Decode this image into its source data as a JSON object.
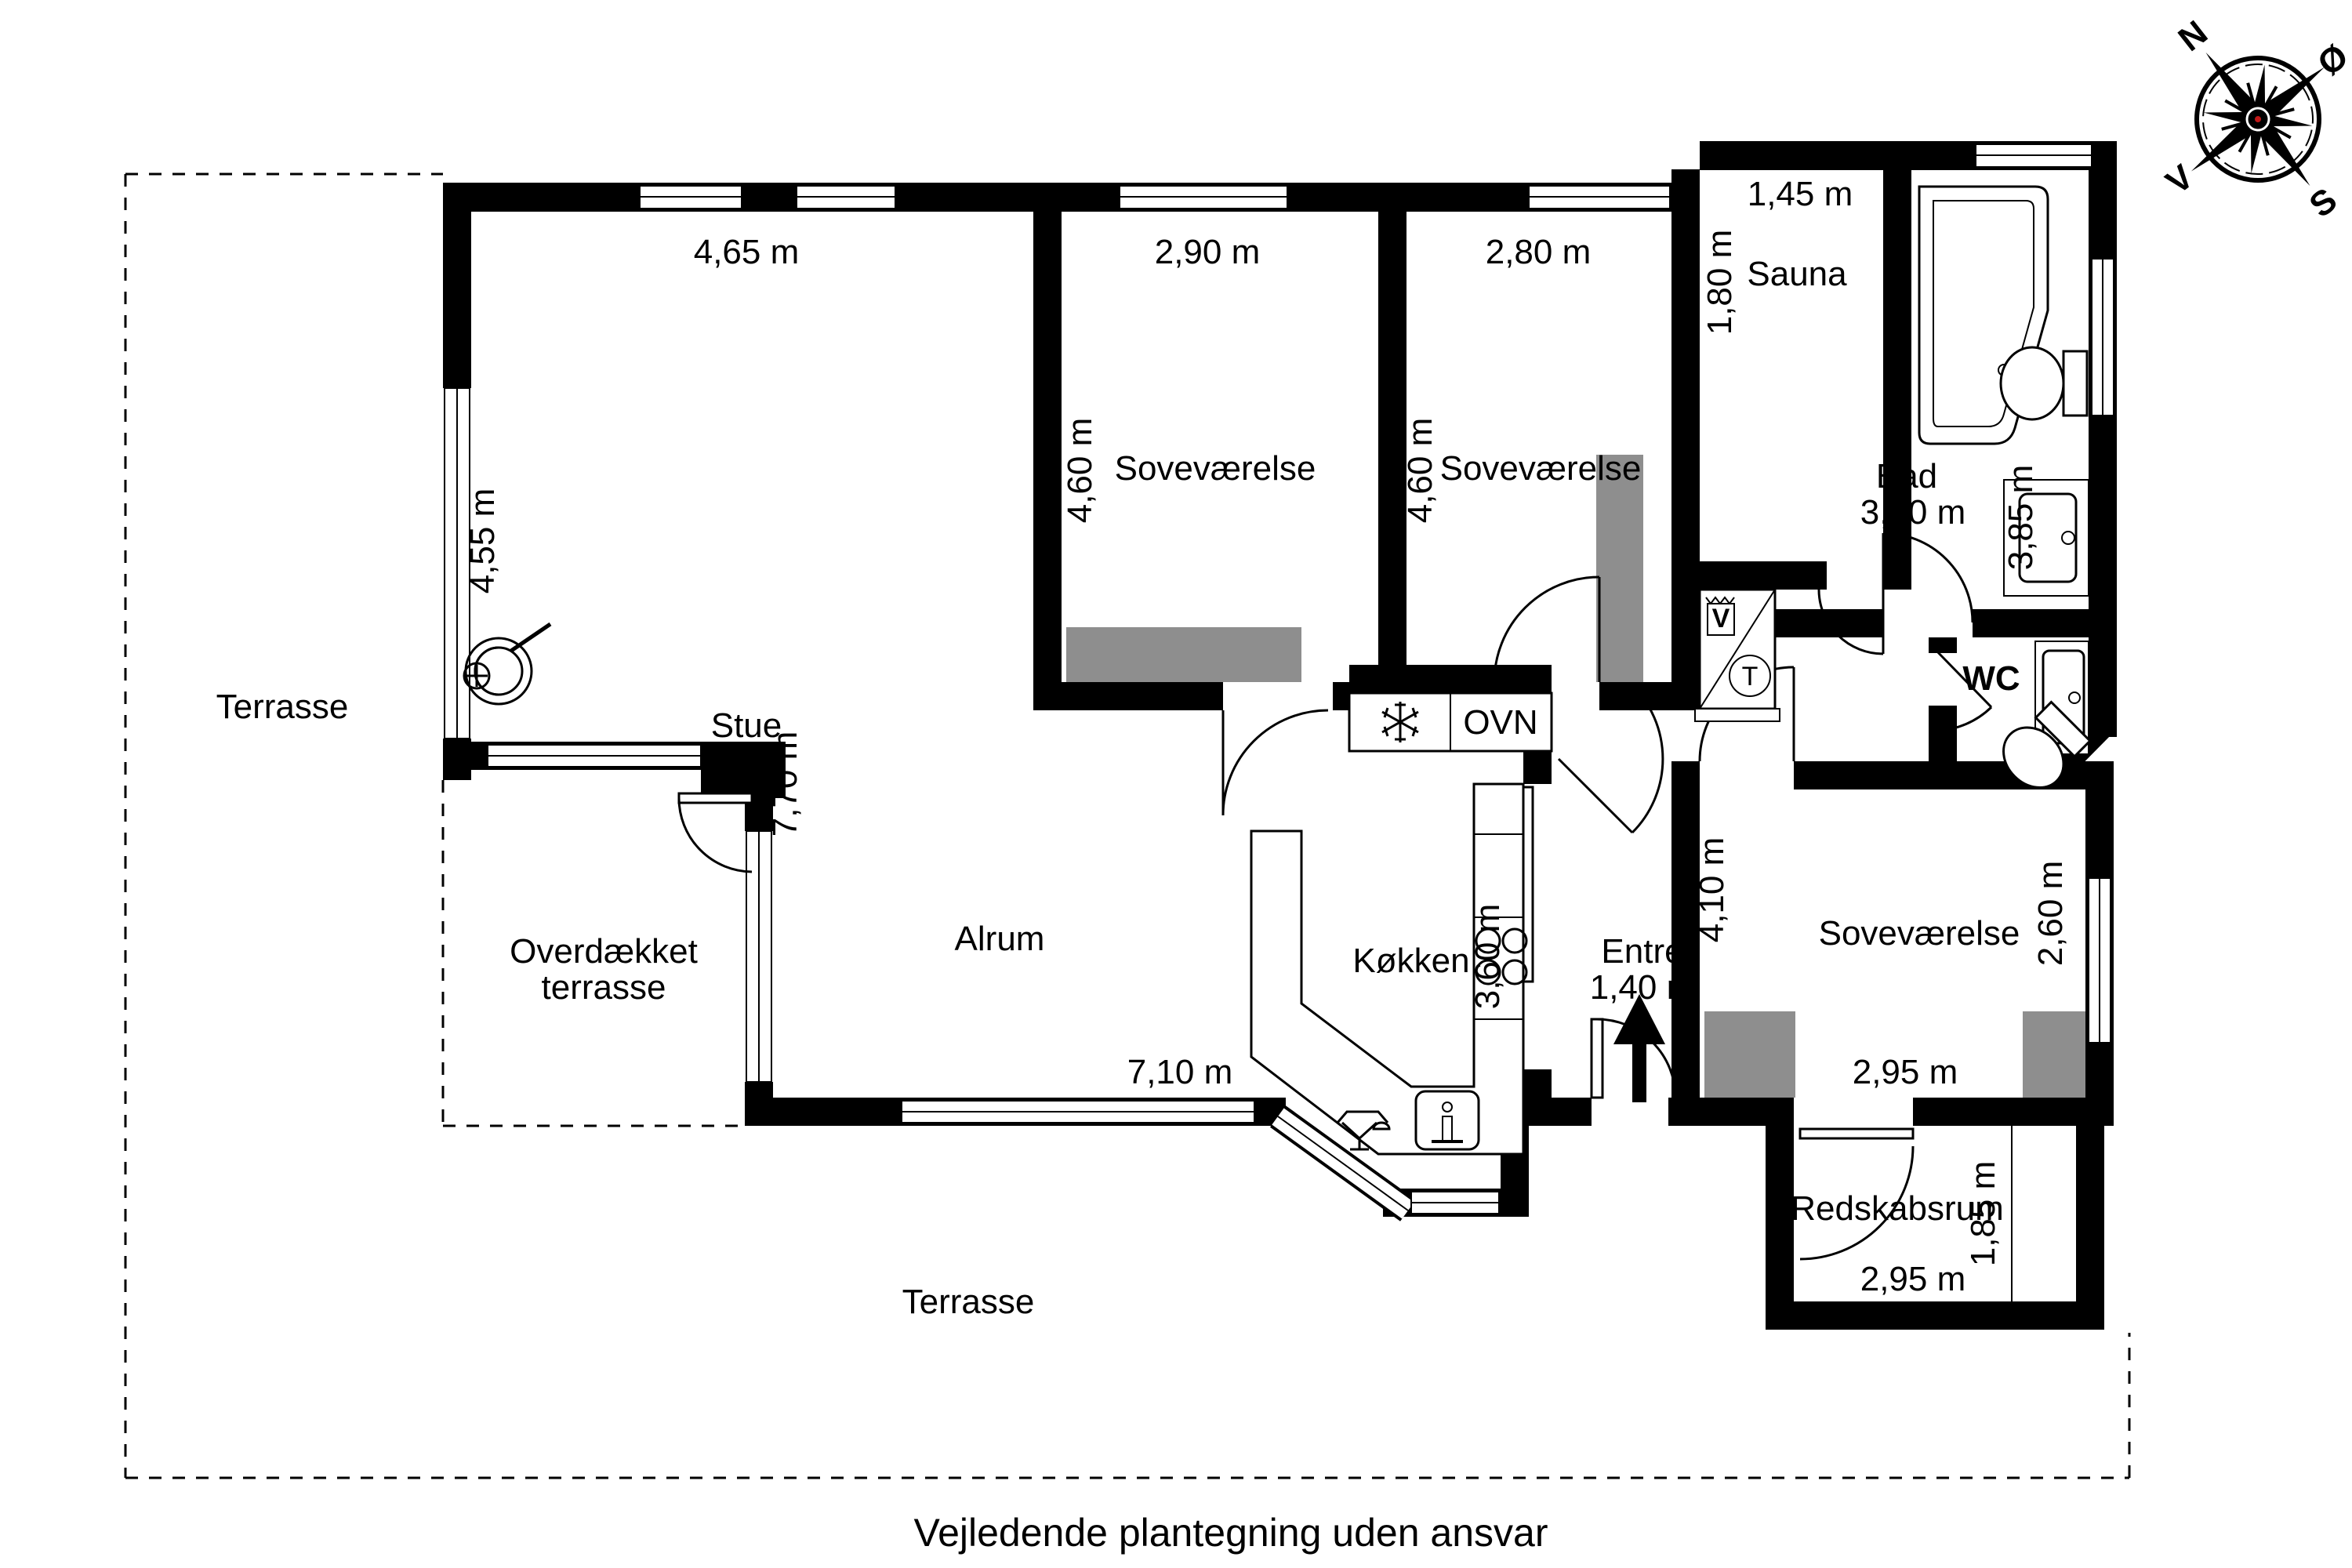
{
  "page": {
    "caption": "Vejledende plantegning uden ansvar"
  },
  "colors": {
    "wall": "#000000",
    "background": "#ffffff",
    "wardrobe": "#8e8e8e",
    "line": "#000000"
  },
  "compass": {
    "north": "N",
    "east": "Ø",
    "south": "S",
    "west": "V"
  },
  "rooms": {
    "stue": {
      "label": "Stue",
      "width": "4,65 m",
      "side": "4,55 m"
    },
    "sovevaerelse1": {
      "label": "Soveværelse",
      "width": "2,90 m",
      "depth": "4,60 m"
    },
    "sovevaerelse2": {
      "label": "Soveværelse",
      "width": "2,80 m",
      "depth": "4,60 m"
    },
    "sauna": {
      "label": "Sauna",
      "width": "1,45 m",
      "depth": "1,80 m"
    },
    "bad": {
      "label": "Bad",
      "width": "3,20 m",
      "depth": "3,85 m"
    },
    "wc": {
      "label": "WC"
    },
    "sovevaerelse3": {
      "label": "Soveværelse",
      "width": "2,95 m",
      "window_side": "2,60 m"
    },
    "entre": {
      "label": "Entré",
      "width": "1,40 m",
      "corridor": "4,10 m"
    },
    "koekken": {
      "label": "Køkken",
      "depth": "3,60 m"
    },
    "alrum": {
      "label": "Alrum",
      "west": "7,70 m",
      "south": "7,10 m"
    },
    "redskabsrum": {
      "label": "Redskabsrum",
      "width": "2,95 m",
      "depth": "1,85 m"
    },
    "terrasse_left": {
      "label": "Terrasse"
    },
    "terrasse_bottom": {
      "label": "Terrasse"
    },
    "overdaekket": {
      "line1": "Overdækket",
      "line2": "terrasse"
    }
  },
  "appliances": {
    "oven": "OVN",
    "washer": "V",
    "dryer": "T"
  }
}
